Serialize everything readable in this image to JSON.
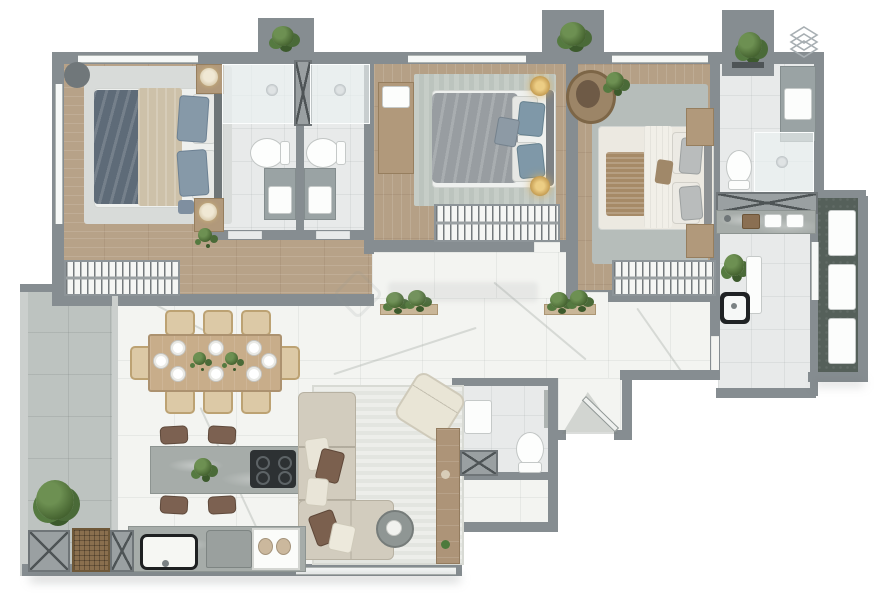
{
  "image": {
    "kind": "3d-rendered-apartment-floor-plan",
    "width_px": 889,
    "height_px": 600,
    "background": "#ffffff",
    "visible_text": "none — the render contains no legible labels or dimensions"
  },
  "branding": {
    "logo_icon": "layers-diamond-icon",
    "logo_position": "top-right",
    "logo_color": "#a8afb3",
    "watermark_present": true,
    "watermark_legible": false,
    "watermark_position": "center-left of corridor"
  },
  "palette": {
    "wall": "#868d91",
    "wall_light": "#cbcfcd",
    "wood_floor": "#b7a288",
    "marble_floor": "#f3f4f1",
    "bathroom_tile": "#e8eaea",
    "balcony_tile": "#bdc3c0",
    "balcony_dark": "#55605a",
    "rug_gray": "#d8dbd9",
    "rug_striped": "#c3cac4",
    "bed_slate_blue": "#5e6b78",
    "bed_beige": "#cdc1a9",
    "bed_gray": "#989da1",
    "pillow_blue": "#8699a8",
    "sofa_beige": "#d2ccbe",
    "pillow_brown": "#7b604e",
    "furniture_wood": "#b1997b",
    "counter_stone": "#a6aca9",
    "hob_black": "#2d3133",
    "plant_green": "#4c6c3c",
    "fixture_white": "#fcfdfc"
  },
  "scene": {
    "layout": "3-bedroom apartment, top row of bedrooms and bathrooms, open living-dining below, balconies left and right, service row at bottom",
    "rooms": [
      {
        "name": "master-bedroom",
        "floor": "wood",
        "furniture": [
          "double-bed",
          "gray-rug",
          "nightstand-with-lamp x2",
          "corner-table",
          "foot-stool",
          "wardrobe-with-hangers",
          "plant"
        ]
      },
      {
        "name": "ensuite-bathroom-1",
        "floor": "tile",
        "furniture": [
          "shower-with-head",
          "toilet",
          "vanity-sink"
        ]
      },
      {
        "name": "ensuite-bathroom-2",
        "floor": "tile",
        "furniture": [
          "shower-with-head",
          "toilet",
          "vanity-sink"
        ]
      },
      {
        "name": "bedroom-2",
        "floor": "wood",
        "furniture": [
          "double-bed",
          "striped-rug",
          "dresser",
          "gold-lamp x2",
          "wardrobe-with-hangers"
        ]
      },
      {
        "name": "bedroom-3",
        "floor": "wood",
        "furniture": [
          "double-bed",
          "gray-rug",
          "nightstand x2",
          "rattan-chair",
          "plant",
          "wardrobe-with-hangers"
        ]
      },
      {
        "name": "bathroom-3",
        "floor": "tile",
        "furniture": [
          "vanity-sink",
          "toilet",
          "shower-enclosure"
        ]
      },
      {
        "name": "utility-nook",
        "floor": "tile",
        "furniture": [
          "service-duct-x",
          "utility-counter-with-faucet"
        ]
      },
      {
        "name": "kitchen",
        "floor": "tile",
        "furniture": [
          "black-sink",
          "plant",
          "tall-white-panel"
        ]
      },
      {
        "name": "living-dining",
        "floor": "marble",
        "furniture": [
          "dining-table-8-seater",
          "dining-chairs x8",
          "place-settings x8",
          "centerpiece-plants x2",
          "kitchen-island-with-hob",
          "bar-stools x4",
          "fruit-bowl",
          "l-shaped-sofa",
          "accent-armchair",
          "round-coffee-table",
          "striped-area-rug",
          "tv-console",
          "wall-planters x2"
        ]
      },
      {
        "name": "common-bathroom",
        "floor": "tile",
        "furniture": [
          "vanity-sink",
          "toilet",
          "service-duct-x",
          "glass-partition"
        ]
      },
      {
        "name": "entry-foyer",
        "floor": "marble",
        "furniture": [
          "entrance-door-swing"
        ]
      },
      {
        "name": "balcony-left",
        "floor": "gray-tile",
        "furniture": [
          "shrub-plant"
        ]
      },
      {
        "name": "balcony-right",
        "floor": "dark-stone",
        "furniture": [
          "white-planter x3"
        ]
      },
      {
        "name": "service-row",
        "floor": "stone-counter",
        "furniture": [
          "duct-x x2",
          "woven-doormat",
          "black-rim-sink",
          "appliance",
          "jar-cabinet"
        ]
      }
    ],
    "plants_at_top_nooks": 3
  }
}
